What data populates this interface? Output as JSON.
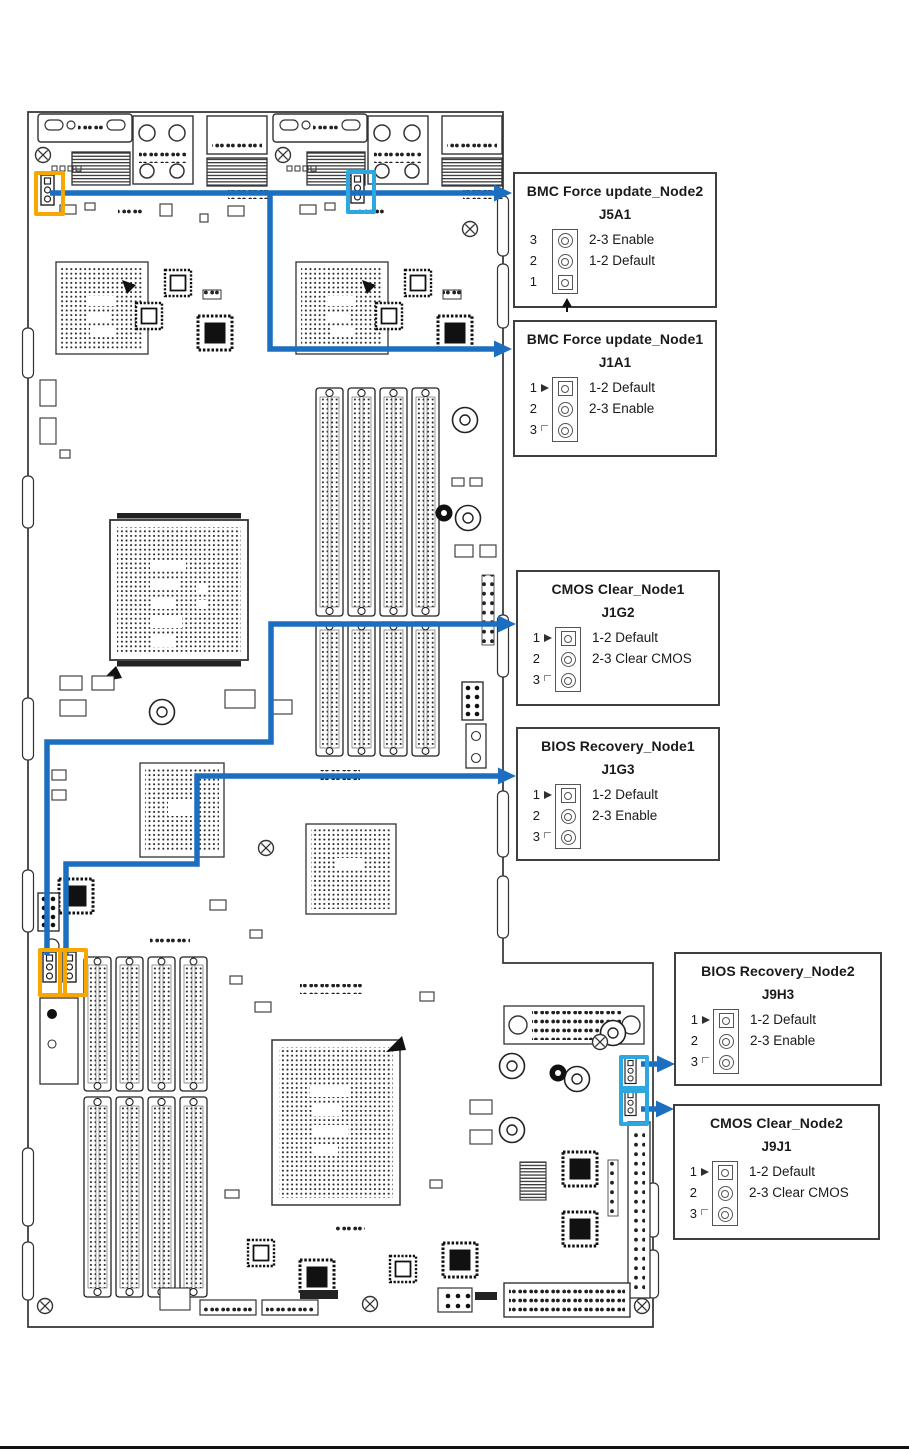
{
  "colors": {
    "accent_blue": "#1c6fc0",
    "highlight_orange": "#f7a700",
    "highlight_cyan": "#2da7e0",
    "callout_border": "#3f3f3f",
    "board_line": "#333333",
    "footer_rule": "#111111"
  },
  "callouts": [
    {
      "title": "BMC Force update_Node2",
      "jumper": "J5A1",
      "rows": [
        {
          "num": "3",
          "label": "2-3 Enable"
        },
        {
          "num": "2",
          "label": "1-2 Default"
        },
        {
          "num": "1",
          "label": ""
        }
      ]
    },
    {
      "title": "BMC Force update_Node1",
      "jumper": "J1A1",
      "rows": [
        {
          "num": "1",
          "label": "1-2 Default"
        },
        {
          "num": "2",
          "label": "2-3 Enable"
        },
        {
          "num": "3",
          "label": ""
        }
      ]
    },
    {
      "title": "CMOS Clear_Node1",
      "jumper": "J1G2",
      "rows": [
        {
          "num": "1",
          "label": "1-2 Default"
        },
        {
          "num": "2",
          "label": "2-3 Clear CMOS"
        },
        {
          "num": "3",
          "label": ""
        }
      ]
    },
    {
      "title": "BIOS Recovery_Node1",
      "jumper": "J1G3",
      "rows": [
        {
          "num": "1",
          "label": "1-2 Default"
        },
        {
          "num": "2",
          "label": "2-3 Enable"
        },
        {
          "num": "3",
          "label": ""
        }
      ]
    },
    {
      "title": "BIOS Recovery_Node2",
      "jumper": "J9H3",
      "rows": [
        {
          "num": "1",
          "label": "1-2 Default"
        },
        {
          "num": "2",
          "label": "2-3 Enable"
        },
        {
          "num": "3",
          "label": ""
        }
      ]
    },
    {
      "title": "CMOS Clear_Node2",
      "jumper": "J9J1",
      "rows": [
        {
          "num": "1",
          "label": "1-2 Default"
        },
        {
          "num": "2",
          "label": "2-3 Clear CMOS"
        },
        {
          "num": "3",
          "label": ""
        }
      ]
    }
  ]
}
